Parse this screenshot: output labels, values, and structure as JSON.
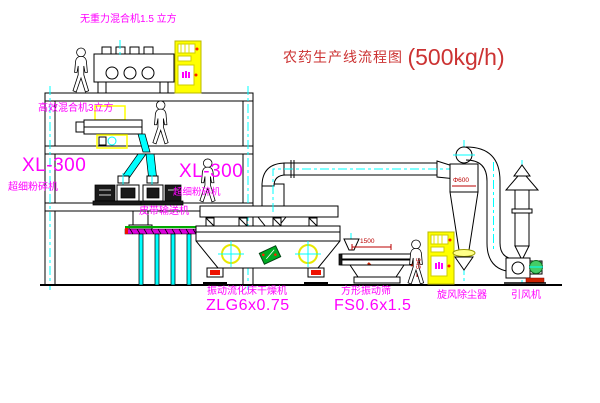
{
  "title": {
    "text": "农药生产线流程图",
    "capacity": "(500kg/h)"
  },
  "labels": {
    "gravity_free_mixer": "无重力混合机1.5 立方",
    "high_efficiency_mixer": "高效混合机3立方",
    "pulverizer_left_model": "XL-300",
    "pulverizer_left_name": "超细粉碎机",
    "pulverizer_mid_model": "XL-300",
    "pulverizer_mid_name": "超细粉碎机",
    "belt_conveyor": "皮带输送机",
    "dryer_name": "振动流化床干燥机",
    "dryer_model": "ZLG6x0.75",
    "sieve_name": "方形振动筛",
    "sieve_model": "FS0.6x1.5",
    "cyclone": "旋风除尘器",
    "induced_draft_fan": "引风机"
  },
  "dimensions": {
    "sieve_length": "1500",
    "sieve_height": "345",
    "cyclone_diameter": "Φ600"
  },
  "colors": {
    "label_magenta": "#ff00ff",
    "title_red": "#cc3333",
    "dimension_red": "#bb0000",
    "centerline_cyan": "#00ffff",
    "equipment_yellow": "#ffff00",
    "conveyor_green": "#00aa00",
    "line_black": "#000000",
    "background": "#ffffff"
  }
}
